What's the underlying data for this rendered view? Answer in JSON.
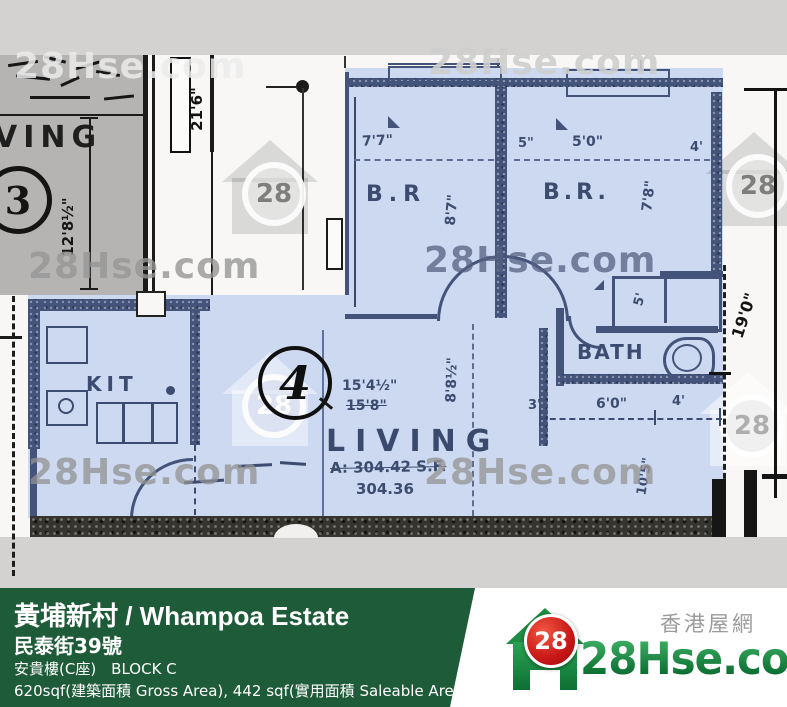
{
  "watermark": {
    "brand": "28Hse.com",
    "badge": "28"
  },
  "plan": {
    "unit3": {
      "number": "3",
      "room": "VING",
      "dim_height": "12'8½\""
    },
    "corridor_dim": "21'6\"",
    "unit4": {
      "number": "4",
      "bedroom1": {
        "label": "B.R",
        "width": "7'7\"",
        "height": "8'7\""
      },
      "bedroom2": {
        "label": "B.R.",
        "label_w_left": "5\"",
        "width": "5'0\"",
        "label_w_right": "4'",
        "height": "7'8\""
      },
      "bath": {
        "label": "BATH"
      },
      "kitchen": {
        "label": "KIT"
      },
      "living": {
        "label": "LIVING",
        "width_new": "15'4½\"",
        "width_old": "15'8\"",
        "height": "8'8½\"",
        "area_line1": "A: 304.42 S.F.",
        "area_line2": "304.36",
        "wall_dim": "10'5\""
      },
      "hall": {
        "left": "3'",
        "mid": "6'0\"",
        "right": "4'"
      },
      "closet_dim": "5'",
      "right_dim": "19'0\""
    }
  },
  "bar": {
    "title": "黃埔新村 / Whampoa Estate",
    "address": "民泰街39號",
    "block": "安貴樓(C座) BLOCK C",
    "area": "620sqf(建築面積 Gross Area), 442 sqf(實用面積 Saleable Area)"
  },
  "logo": {
    "brand": "28Hse.com",
    "badge": "28",
    "tagline": "香港屋網"
  }
}
